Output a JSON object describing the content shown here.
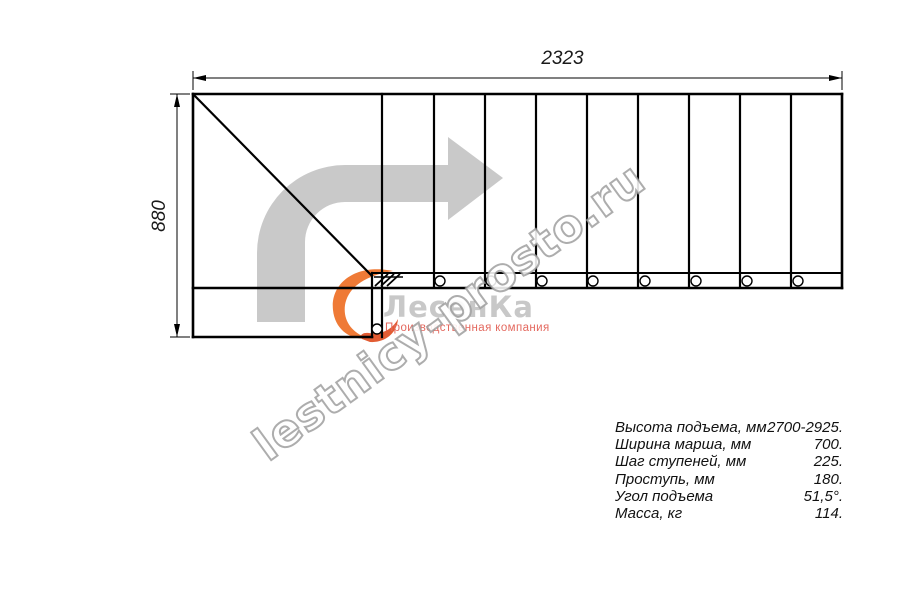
{
  "drawing": {
    "width_dimension": "2323",
    "height_dimension": "880",
    "tread_count": 9,
    "bolt_circle_count": 9
  },
  "watermark": {
    "text": "lestnicy-prosto.ru"
  },
  "logo": {
    "brand": "ЛесенКа",
    "subtitle": "Производственная компания"
  },
  "specs": {
    "rows": [
      {
        "label": "Высота подъема, мм",
        "value": "2700-2925."
      },
      {
        "label": "Ширина марша, мм",
        "value": "700."
      },
      {
        "label": "Шаг ступеней, мм",
        "value": "225."
      },
      {
        "label": "Проступь, мм",
        "value": "180."
      },
      {
        "label": "Угол подъема",
        "value": "51,5°."
      },
      {
        "label": "Масса, кг",
        "value": "114."
      }
    ]
  },
  "colors": {
    "line": "#000000",
    "direction_arrow": "#c9c9c9",
    "watermark_stroke": "#999999",
    "logo_text": "#c8c8c8",
    "logo_subtitle": "#e4695f",
    "logo_accent": "#e8622d"
  }
}
